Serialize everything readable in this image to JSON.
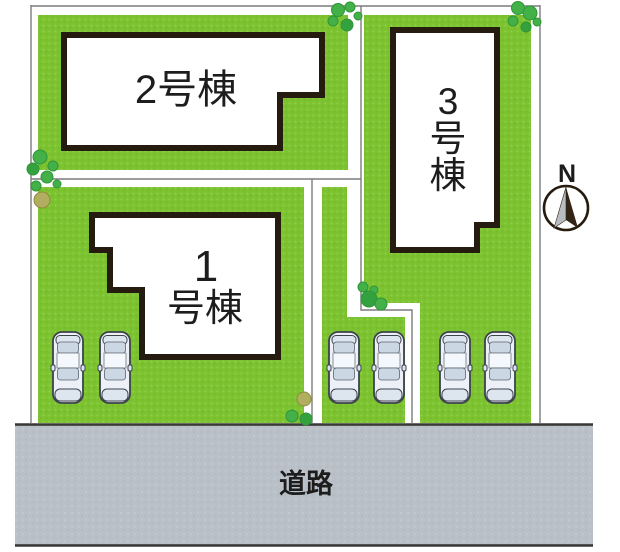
{
  "plan": {
    "buildings": {
      "b1": {
        "line1": "1",
        "line2": "号棟",
        "full_label": "1号棟"
      },
      "b2": {
        "label": "2号棟"
      },
      "b3": {
        "char1": "3",
        "char2": "号",
        "char3": "棟",
        "full_label": "3号棟"
      }
    },
    "road": {
      "label": "道路"
    },
    "compass": {
      "label": "N"
    },
    "parking": {
      "car_count": 6
    },
    "colors": {
      "lawn": "#7dc331",
      "lawn_light": "#90d34c",
      "lawn_dark": "#6db31f",
      "road": "#b9c0c8",
      "road_light": "#c5ccd4",
      "road_dark": "#adb4bc",
      "road_edge": "#383838",
      "boundary": "#7c7c7c",
      "building_outline": "#251b0e",
      "text": "#1d1d1d",
      "tree": "#43b048",
      "tree_edge": "#2e9638",
      "tree_dark": "#33a23e",
      "tree_olive": "#b2ae60",
      "tree_olive_edge": "#908c3f",
      "car_body": "#edf1f7",
      "car_glass": "#ccd7e4",
      "car_trim": "#dde5ee",
      "car_outline": "#3d434c",
      "compass_left": "#b9bdc1",
      "compass_right": "#332418"
    }
  }
}
